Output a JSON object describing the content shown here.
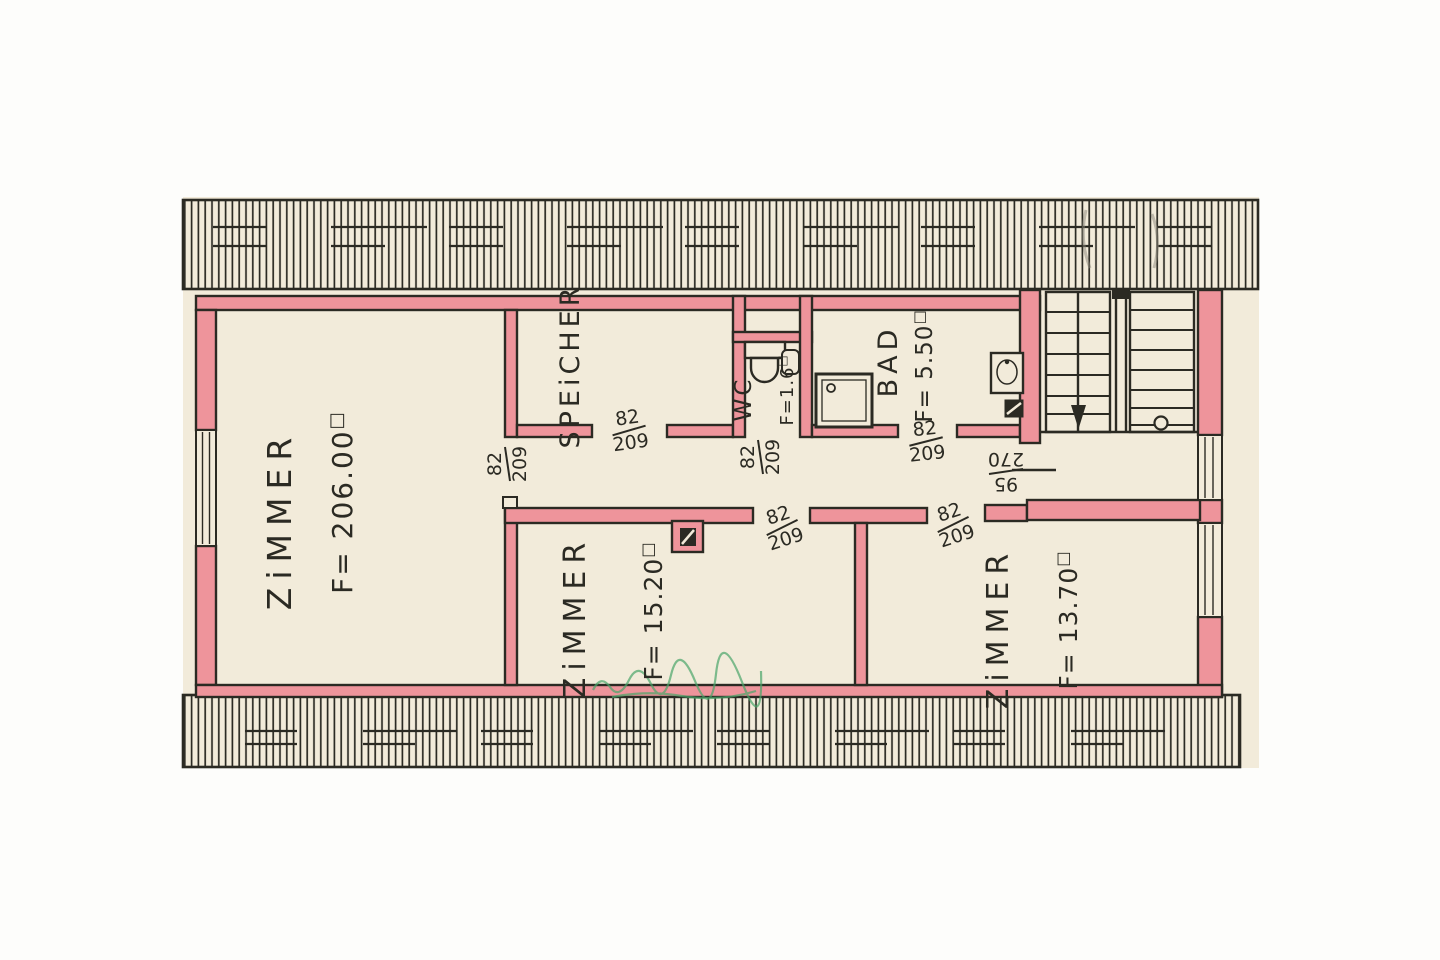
{
  "colors": {
    "wall_pink": "#ee949b",
    "paper": "#f2ebda",
    "ink": "#2b2a23",
    "green": "#4aa56a",
    "pencil": "#8a857a"
  },
  "rooms": {
    "zimmer_left": {
      "name": "ZiMMER",
      "area": "F= 206.00",
      "area_unit": "□"
    },
    "speicher": {
      "name": "SPEiCHER"
    },
    "wc": {
      "name": "WC",
      "area": "F=1.6",
      "area_unit": "□"
    },
    "bad": {
      "name": "BAD",
      "area": "F= 5.50",
      "area_unit": "□"
    },
    "zimmer_mid": {
      "name": "ZiMMER",
      "area": "F= 15.20",
      "area_unit": "□"
    },
    "zimmer_right": {
      "name": "ZiMMER",
      "area": "F= 13.70",
      "area_unit": "□"
    }
  },
  "door_labels": [
    {
      "width": "82",
      "height": "209"
    },
    {
      "width": "82",
      "height": "209"
    },
    {
      "width": "82",
      "height": "209"
    },
    {
      "width": "82",
      "height": "209"
    },
    {
      "width": "82",
      "height": "209"
    },
    {
      "width": "82",
      "height": "209"
    },
    {
      "width": "95",
      "height": "270"
    }
  ]
}
